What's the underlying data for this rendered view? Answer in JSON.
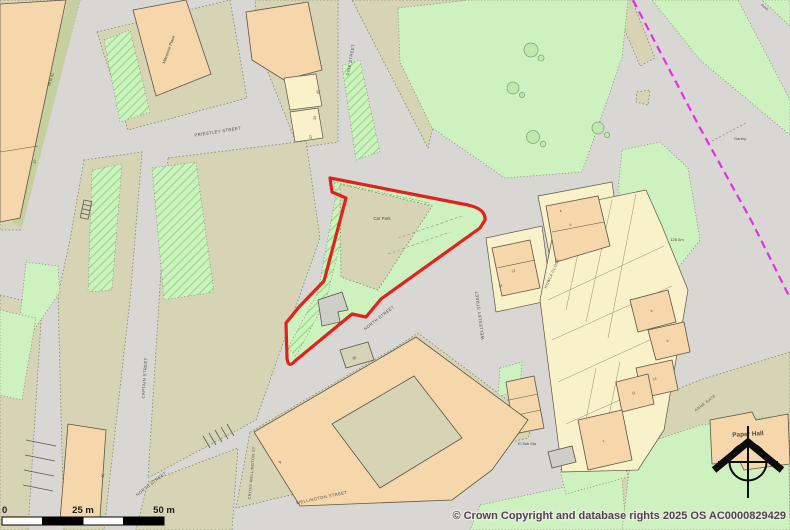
{
  "colors": {
    "road": "#d8d7d4",
    "olive": "#d7d4b5",
    "light_green": "#cdf2bf",
    "hatch_green": "#90d980",
    "strip_green": "#c5cfa0",
    "peach": "#f6d7ab",
    "cream": "#f8f1c9",
    "building_outline": "#5d5444",
    "parcel_dot": "#85856e",
    "boundary_red": "#e3211c",
    "admin_magenta": "#e62ee6",
    "text": "#4c4c40"
  },
  "labels": [
    {
      "text": "PRIESTLEY STREET",
      "x": 218,
      "y": 133,
      "rot": -9,
      "size": 4.2,
      "cls": "street",
      "name": "street-label-priestley-street"
    },
    {
      "text": "PINE STREET",
      "x": 352,
      "y": 60,
      "rot": -80,
      "size": 4.2,
      "cls": "street",
      "name": "street-label-pine-street"
    },
    {
      "text": "Milestone Place",
      "x": 170,
      "y": 50,
      "rot": -70,
      "size": 4.2,
      "name": "building-label-milestone-place"
    },
    {
      "text": "39 to 41",
      "x": 52,
      "y": 80,
      "rot": -72,
      "size": 3.8,
      "name": "house-number"
    },
    {
      "text": "37",
      "x": 36,
      "y": 162,
      "rot": -72,
      "size": 3.8,
      "name": "house-number"
    },
    {
      "text": "45",
      "x": 319,
      "y": 92,
      "rot": -85,
      "size": 3.6,
      "name": "house-number"
    },
    {
      "text": "39",
      "x": 316,
      "y": 118,
      "rot": -85,
      "size": 3.6,
      "name": "house-number"
    },
    {
      "text": "37",
      "x": 312,
      "y": 137,
      "rot": -85,
      "size": 3.6,
      "name": "house-number"
    },
    {
      "text": "Car Park",
      "x": 382,
      "y": 220,
      "rot": 0,
      "size": 4.4,
      "name": "area-label-car-park"
    },
    {
      "text": "NORTH STREET",
      "x": 380,
      "y": 319,
      "rot": -38,
      "size": 4.2,
      "cls": "street",
      "name": "street-label-north-street"
    },
    {
      "text": "NORTH STREET",
      "x": 152,
      "y": 485,
      "rot": -38,
      "size": 4.2,
      "cls": "street",
      "name": "street-label-north-street"
    },
    {
      "text": "CAPTAIN STREET",
      "x": 146,
      "y": 378,
      "rot": -86,
      "size": 4.2,
      "cls": "street",
      "name": "street-label-captain-street"
    },
    {
      "text": "WELLESLEY STREET",
      "x": 481,
      "y": 315,
      "rot": -97,
      "size": 4.2,
      "cls": "street",
      "name": "street-label-wellesley-street"
    },
    {
      "text": "CROSS WELLINGTON ST",
      "x": 253,
      "y": 473,
      "rot": -85,
      "size": 3.8,
      "cls": "street",
      "name": "street-label-cross-wellington-st"
    },
    {
      "text": "WELLINGTON STREET",
      "x": 322,
      "y": 499,
      "rot": -12,
      "size": 4.2,
      "cls": "street",
      "name": "street-label-wellington-street"
    },
    {
      "text": "HOWLA CLOSE",
      "x": 553,
      "y": 274,
      "rot": -66,
      "size": 3.8,
      "cls": "street",
      "name": "street-label-howla-close"
    },
    {
      "text": "ANNE GATE",
      "x": 706,
      "y": 404,
      "rot": -37,
      "size": 3.8,
      "cls": "street",
      "name": "street-label-anne-gate"
    },
    {
      "text": "Gantry",
      "x": 740,
      "y": 140,
      "rot": 0,
      "size": 4,
      "name": "map-label-gantry"
    },
    {
      "text": "126.5m",
      "x": 677,
      "y": 241,
      "rot": 0,
      "size": 4,
      "name": "spot-height-label"
    },
    {
      "text": "El Sub Sta",
      "x": 527,
      "y": 445,
      "rot": 0,
      "size": 3.8,
      "name": "map-label-el-sub-sta"
    },
    {
      "text": "Paper Hall",
      "x": 748,
      "y": 436,
      "rot": -3,
      "size": 6.4,
      "bold": true,
      "name": "building-label-paper-hall"
    },
    {
      "text": "Rosie",
      "x": 764,
      "y": 8,
      "rot": 38,
      "size": 3.4,
      "name": "map-label-small"
    },
    {
      "text": "12",
      "x": 514,
      "y": 272,
      "rot": -25,
      "size": 3.4,
      "name": "house-number"
    },
    {
      "text": "14",
      "x": 501,
      "y": 287,
      "rot": -25,
      "size": 3.4,
      "name": "house-number"
    },
    {
      "text": "4",
      "x": 561,
      "y": 212,
      "rot": -25,
      "size": 3.4,
      "name": "house-number"
    },
    {
      "text": "6",
      "x": 571,
      "y": 226,
      "rot": -25,
      "size": 3.4,
      "name": "house-number"
    },
    {
      "text": "8",
      "x": 652,
      "y": 312,
      "rot": -25,
      "size": 3.4,
      "name": "house-number"
    },
    {
      "text": "6",
      "x": 668,
      "y": 342,
      "rot": -25,
      "size": 3.4,
      "name": "house-number"
    },
    {
      "text": "13",
      "x": 655,
      "y": 380,
      "rot": -25,
      "size": 3.4,
      "name": "house-number"
    },
    {
      "text": "11",
      "x": 634,
      "y": 394,
      "rot": -25,
      "size": 3.4,
      "name": "house-number"
    },
    {
      "text": "1",
      "x": 604,
      "y": 442,
      "rot": -25,
      "size": 3.4,
      "name": "house-number"
    },
    {
      "text": "9",
      "x": 281,
      "y": 463,
      "rot": -50,
      "size": 4,
      "name": "house-number"
    },
    {
      "text": "40",
      "x": 104,
      "y": 476,
      "rot": -80,
      "size": 3.8,
      "name": "house-number"
    },
    {
      "text": "35",
      "x": 355,
      "y": 359,
      "rot": -37,
      "size": 3.8,
      "name": "house-number"
    }
  ],
  "scale_bar": {
    "zero": "0",
    "mid": "25 m",
    "end": "50 m"
  },
  "attribution": "© Crown Copyright and database rights 2025 OS AC0000829429"
}
